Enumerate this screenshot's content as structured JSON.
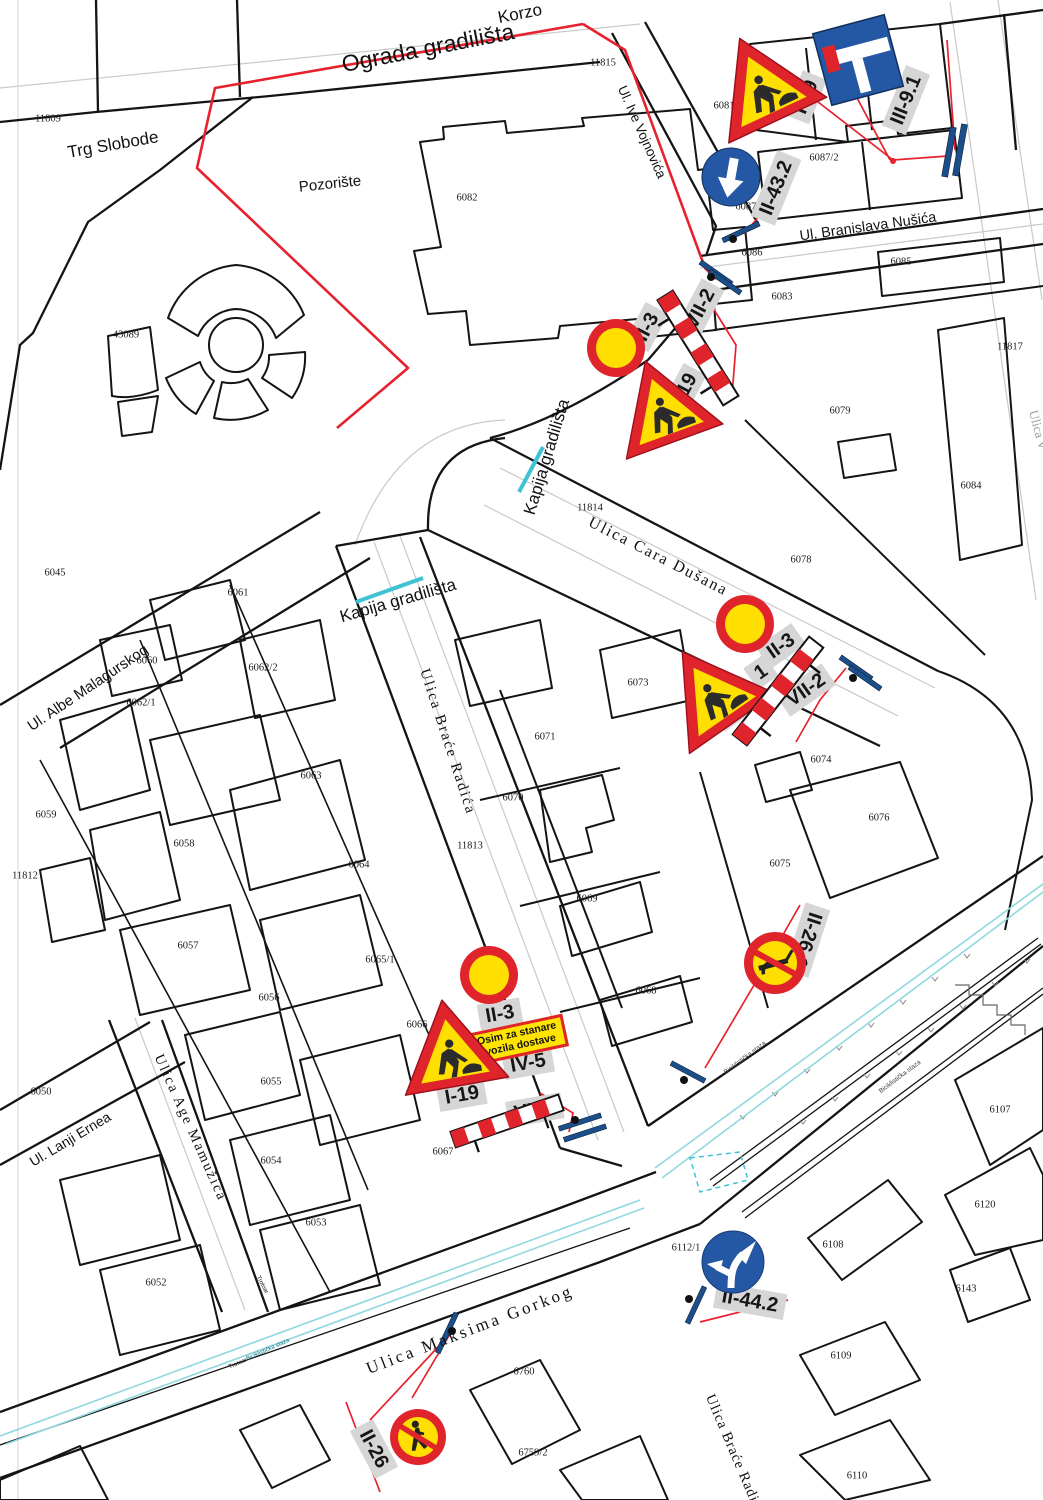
{
  "title": "Plan privremene saobraćajne signalizacije gradilišta",
  "colors": {
    "fence_red": "#e8212e",
    "sign_red": "#e0242c",
    "sign_yellow": "#ffdf00",
    "sign_blue": "#2457a4",
    "gate_cyan": "#3fc3d4",
    "bike_lane_cyan": "#8fd8de",
    "post_blue": "#1c4f8a",
    "label_plate_gray": "#d6d6d6",
    "parcel_line": "#141414"
  },
  "map": {
    "street_labels": [
      {
        "text": "Korzo",
        "x": 520,
        "y": 14,
        "rot": -11,
        "size": 17
      },
      {
        "text": "Ograda gradilišta",
        "x": 428,
        "y": 48,
        "rot": -11,
        "size": 23
      },
      {
        "text": "Trg Slobode",
        "x": 113,
        "y": 145,
        "rot": -10,
        "size": 17
      },
      {
        "text": "Pozorište",
        "x": 330,
        "y": 184,
        "rot": -6,
        "size": 15
      },
      {
        "text": "Ul. Ive Vojnovića",
        "x": 642,
        "y": 132,
        "rot": 66,
        "size": 13.5
      },
      {
        "text": "Ul. Branislava Nušića",
        "x": 868,
        "y": 227,
        "rot": -8,
        "size": 14.5
      },
      {
        "text": "Ulica Cara Dušana",
        "x": 658,
        "y": 557,
        "rot": 27,
        "size": 16,
        "font": "serif",
        "spacing": 2
      },
      {
        "text": "Kapija gradilišta",
        "x": 547,
        "y": 457,
        "rot": -73,
        "size": 17
      },
      {
        "text": "Kapija gradilišta",
        "x": 398,
        "y": 601,
        "rot": -16,
        "size": 17
      },
      {
        "text": "Ulica Braće Radića",
        "x": 447,
        "y": 742,
        "rot": 72,
        "size": 15,
        "font": "serif",
        "spacing": 2
      },
      {
        "text": "Ul. Albe Malagurskog",
        "x": 88,
        "y": 688,
        "rot": -34,
        "size": 15
      },
      {
        "text": "Ulica Age Mamužića",
        "x": 190,
        "y": 1128,
        "rot": 66,
        "size": 14.5,
        "font": "serif",
        "spacing": 2
      },
      {
        "text": "Ul. Lanji Ernea",
        "x": 70,
        "y": 1139,
        "rot": -31,
        "size": 14
      },
      {
        "text": "Ulica  Maksima  Gorkog",
        "x": 470,
        "y": 1330,
        "rot": -21,
        "size": 17,
        "font": "serif",
        "spacing": 3
      },
      {
        "text": "Ulica Braće Radić",
        "x": 733,
        "y": 1452,
        "rot": 67,
        "size": 14.5,
        "font": "serif",
        "spacing": 1
      },
      {
        "text": "Ulica V",
        "x": 1038,
        "y": 430,
        "rot": 75,
        "size": 13,
        "font": "serif",
        "color": "#9a9a9a"
      }
    ],
    "parcel_labels": [
      {
        "text": "11809",
        "x": 48,
        "y": 119
      },
      {
        "text": "11815",
        "x": 603,
        "y": 63
      },
      {
        "text": "6081",
        "x": 724,
        "y": 106
      },
      {
        "text": "6082",
        "x": 467,
        "y": 198
      },
      {
        "text": "6087/2",
        "x": 824,
        "y": 158
      },
      {
        "text": "6087/1",
        "x": 750,
        "y": 207
      },
      {
        "text": "6086",
        "x": 752,
        "y": 253
      },
      {
        "text": "6085",
        "x": 901,
        "y": 262
      },
      {
        "text": "6083",
        "x": 782,
        "y": 297
      },
      {
        "text": "11817",
        "x": 1010,
        "y": 347
      },
      {
        "text": "6079",
        "x": 840,
        "y": 411
      },
      {
        "text": "6084",
        "x": 971,
        "y": 486
      },
      {
        "text": "6078",
        "x": 801,
        "y": 560
      },
      {
        "text": "11814",
        "x": 590,
        "y": 508
      },
      {
        "text": "43089",
        "x": 126,
        "y": 335
      },
      {
        "text": "6045",
        "x": 55,
        "y": 573
      },
      {
        "text": "6061",
        "x": 238,
        "y": 593
      },
      {
        "text": "6060",
        "x": 147,
        "y": 661
      },
      {
        "text": "6062/2",
        "x": 263,
        "y": 668
      },
      {
        "text": "6062/1",
        "x": 141,
        "y": 703
      },
      {
        "text": "6063",
        "x": 311,
        "y": 776
      },
      {
        "text": "6059",
        "x": 46,
        "y": 815
      },
      {
        "text": "6058",
        "x": 184,
        "y": 844
      },
      {
        "text": "11812",
        "x": 25,
        "y": 876
      },
      {
        "text": "6064",
        "x": 359,
        "y": 865
      },
      {
        "text": "6073",
        "x": 638,
        "y": 683
      },
      {
        "text": "6071",
        "x": 545,
        "y": 737
      },
      {
        "text": "6070",
        "x": 513,
        "y": 798
      },
      {
        "text": "6074",
        "x": 821,
        "y": 760
      },
      {
        "text": "6076",
        "x": 879,
        "y": 818
      },
      {
        "text": "6075",
        "x": 780,
        "y": 864
      },
      {
        "text": "6069",
        "x": 587,
        "y": 899
      },
      {
        "text": "6068",
        "x": 646,
        "y": 991
      },
      {
        "text": "6057",
        "x": 188,
        "y": 946
      },
      {
        "text": "6065/1",
        "x": 380,
        "y": 960
      },
      {
        "text": "6056",
        "x": 269,
        "y": 998
      },
      {
        "text": "6066",
        "x": 417,
        "y": 1025
      },
      {
        "text": "6055",
        "x": 271,
        "y": 1082
      },
      {
        "text": "6050",
        "x": 41,
        "y": 1092
      },
      {
        "text": "6054",
        "x": 271,
        "y": 1161
      },
      {
        "text": "6067",
        "x": 443,
        "y": 1152
      },
      {
        "text": "6053",
        "x": 316,
        "y": 1223
      },
      {
        "text": "6052",
        "x": 156,
        "y": 1283
      },
      {
        "text": "11813",
        "x": 470,
        "y": 846
      },
      {
        "text": "6107",
        "x": 1000,
        "y": 1110
      },
      {
        "text": "6120",
        "x": 985,
        "y": 1205
      },
      {
        "text": "6112/1",
        "x": 686,
        "y": 1248
      },
      {
        "text": "6108",
        "x": 833,
        "y": 1245
      },
      {
        "text": "6109",
        "x": 841,
        "y": 1356
      },
      {
        "text": "6110",
        "x": 857,
        "y": 1476
      },
      {
        "text": "6143",
        "x": 966,
        "y": 1289
      },
      {
        "text": "6759/2",
        "x": 533,
        "y": 1453
      },
      {
        "text": "6760",
        "x": 524,
        "y": 1372
      }
    ],
    "tiny_labels": [
      {
        "text": "Trotoar",
        "x": 238,
        "y": 1364,
        "rot": -24,
        "size": 6
      },
      {
        "text": "Biciklistička staza",
        "x": 268,
        "y": 1350,
        "rot": -24,
        "size": 6,
        "color": "#0a7080"
      },
      {
        "text": "Biciklistička staza",
        "x": 745,
        "y": 1058,
        "rot": -37,
        "size": 6.5,
        "color": "#444"
      },
      {
        "text": "Biciklistička staza",
        "x": 900,
        "y": 1077,
        "rot": -37,
        "size": 6.5,
        "color": "#444"
      },
      {
        "text": "Trotoar",
        "x": 262,
        "y": 1285,
        "rot": 62,
        "size": 6
      }
    ],
    "sign_code_labels": [
      {
        "text": "I-19",
        "x": 806,
        "y": 97,
        "rot": -68
      },
      {
        "text": "III-9.1",
        "x": 906,
        "y": 100,
        "rot": -68
      },
      {
        "text": "II-43.2",
        "x": 776,
        "y": 188,
        "rot": -68
      },
      {
        "text": "II-3",
        "x": 647,
        "y": 327,
        "rot": -62
      },
      {
        "text": "VII-2",
        "x": 700,
        "y": 309,
        "rot": -62
      },
      {
        "text": "I-19",
        "x": 684,
        "y": 390,
        "rot": -62
      },
      {
        "text": "II-3",
        "x": 781,
        "y": 646,
        "rot": -35
      },
      {
        "text": "1",
        "x": 761,
        "y": 672,
        "rot": -35
      },
      {
        "text": "I-19",
        "x": 737,
        "y": 707,
        "rot": -35
      },
      {
        "text": "VII-2",
        "x": 806,
        "y": 690,
        "rot": -35
      },
      {
        "text": "II-3",
        "x": 500,
        "y": 1014,
        "rot": -10
      },
      {
        "text": "IV-5",
        "x": 528,
        "y": 1063,
        "rot": -10
      },
      {
        "text": "I-19",
        "x": 462,
        "y": 1095,
        "rot": -10
      },
      {
        "text": "VII-2",
        "x": 535,
        "y": 1110,
        "rot": -10
      },
      {
        "text": "II-26.1",
        "x": 807,
        "y": 940,
        "rot": 108
      },
      {
        "text": "II-26",
        "x": 374,
        "y": 1449,
        "rot": 62
      },
      {
        "text": "II-44.2",
        "x": 750,
        "y": 1301,
        "rot": 10
      }
    ],
    "panel_iv5": {
      "line1": "Osim za stanare",
      "line2": "i vozila dostave"
    }
  }
}
